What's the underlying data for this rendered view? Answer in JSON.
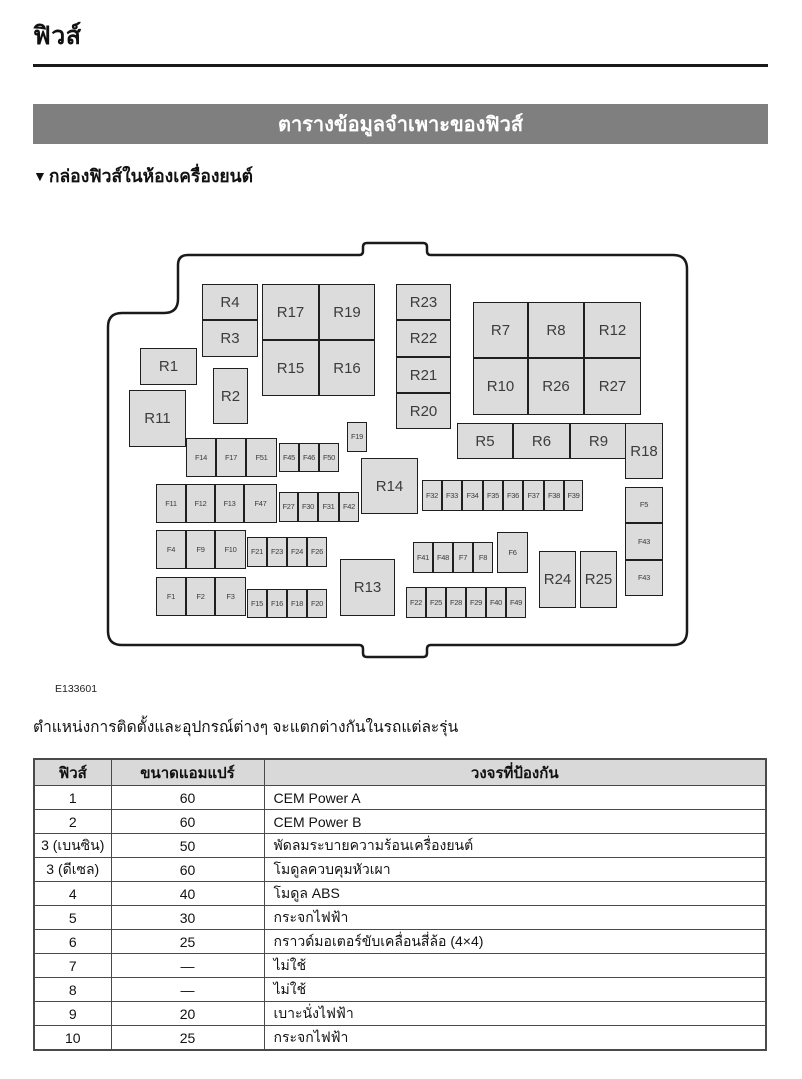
{
  "header": {
    "title": "ฟิวส์",
    "banner": "ตารางข้อมูลจำเพาะของฟิวส์",
    "subsection_marker": "▼",
    "subsection": "กล่องฟิวส์ในห้องเครื่องยนต์"
  },
  "figure": {
    "caption": "E133601",
    "boxes": [
      {
        "id": "R4",
        "x": 99,
        "y": 44,
        "w": 56,
        "h": 36,
        "size": "lg"
      },
      {
        "id": "R3",
        "x": 99,
        "y": 80,
        "w": 56,
        "h": 37,
        "size": "lg"
      },
      {
        "id": "R17",
        "x": 159,
        "y": 44,
        "w": 57,
        "h": 56,
        "size": "lg"
      },
      {
        "id": "R19",
        "x": 216,
        "y": 44,
        "w": 56,
        "h": 56,
        "size": "lg"
      },
      {
        "id": "R15",
        "x": 159,
        "y": 100,
        "w": 57,
        "h": 56,
        "size": "lg"
      },
      {
        "id": "R16",
        "x": 216,
        "y": 100,
        "w": 56,
        "h": 56,
        "size": "lg"
      },
      {
        "id": "R1",
        "x": 37,
        "y": 108,
        "w": 57,
        "h": 37,
        "size": "lg"
      },
      {
        "id": "R2",
        "x": 110,
        "y": 128,
        "w": 35,
        "h": 56,
        "size": "lg"
      },
      {
        "id": "R11",
        "x": 26,
        "y": 150,
        "w": 57,
        "h": 57,
        "size": "lg"
      },
      {
        "id": "R23",
        "x": 293,
        "y": 44,
        "w": 55,
        "h": 36,
        "size": "lg"
      },
      {
        "id": "R22",
        "x": 293,
        "y": 80,
        "w": 55,
        "h": 37,
        "size": "lg"
      },
      {
        "id": "R21",
        "x": 293,
        "y": 117,
        "w": 55,
        "h": 36,
        "size": "lg"
      },
      {
        "id": "R20",
        "x": 293,
        "y": 153,
        "w": 55,
        "h": 36,
        "size": "lg"
      },
      {
        "id": "R7",
        "x": 370,
        "y": 62,
        "w": 55,
        "h": 56,
        "size": "lg"
      },
      {
        "id": "R8",
        "x": 425,
        "y": 62,
        "w": 56,
        "h": 56,
        "size": "lg"
      },
      {
        "id": "R12",
        "x": 481,
        "y": 62,
        "w": 57,
        "h": 56,
        "size": "lg"
      },
      {
        "id": "R10",
        "x": 370,
        "y": 118,
        "w": 55,
        "h": 57,
        "size": "lg"
      },
      {
        "id": "R26",
        "x": 425,
        "y": 118,
        "w": 56,
        "h": 57,
        "size": "lg"
      },
      {
        "id": "R27",
        "x": 481,
        "y": 118,
        "w": 57,
        "h": 57,
        "size": "lg"
      },
      {
        "id": "R5",
        "x": 354,
        "y": 183,
        "w": 56,
        "h": 36,
        "size": "lg"
      },
      {
        "id": "R6",
        "x": 410,
        "y": 183,
        "w": 57,
        "h": 36,
        "size": "lg"
      },
      {
        "id": "R9",
        "x": 467,
        "y": 183,
        "w": 57,
        "h": 36,
        "size": "lg"
      },
      {
        "id": "R18",
        "x": 522,
        "y": 183,
        "w": 38,
        "h": 56,
        "size": "lg"
      },
      {
        "id": "R14",
        "x": 258,
        "y": 218,
        "w": 57,
        "h": 56,
        "size": "lg"
      },
      {
        "id": "R13",
        "x": 237,
        "y": 319,
        "w": 55,
        "h": 57,
        "size": "lg"
      },
      {
        "id": "R24",
        "x": 436,
        "y": 311,
        "w": 37,
        "h": 57,
        "size": "lg"
      },
      {
        "id": "R25",
        "x": 477,
        "y": 311,
        "w": 37,
        "h": 57,
        "size": "lg"
      },
      {
        "id": "F14",
        "x": 83,
        "y": 198,
        "w": 30,
        "h": 39,
        "size": "sm"
      },
      {
        "id": "F17",
        "x": 113,
        "y": 198,
        "w": 30,
        "h": 39,
        "size": "sm"
      },
      {
        "id": "F51",
        "x": 143,
        "y": 198,
        "w": 31,
        "h": 39,
        "size": "sm"
      },
      {
        "id": "F45",
        "x": 176,
        "y": 203,
        "w": 20,
        "h": 29,
        "size": "sm"
      },
      {
        "id": "F46",
        "x": 196,
        "y": 203,
        "w": 20,
        "h": 29,
        "size": "sm"
      },
      {
        "id": "F50",
        "x": 216,
        "y": 203,
        "w": 20,
        "h": 29,
        "size": "sm"
      },
      {
        "id": "F11",
        "x": 53,
        "y": 244,
        "w": 30,
        "h": 39,
        "size": "sm"
      },
      {
        "id": "F12",
        "x": 83,
        "y": 244,
        "w": 29,
        "h": 39,
        "size": "sm"
      },
      {
        "id": "F13",
        "x": 112,
        "y": 244,
        "w": 29,
        "h": 39,
        "size": "sm"
      },
      {
        "id": "F47",
        "x": 141,
        "y": 244,
        "w": 33,
        "h": 39,
        "size": "sm"
      },
      {
        "id": "F27",
        "x": 176,
        "y": 252,
        "w": 19,
        "h": 30,
        "size": "sm"
      },
      {
        "id": "F30",
        "x": 195,
        "y": 252,
        "w": 20,
        "h": 30,
        "size": "sm"
      },
      {
        "id": "F31",
        "x": 215,
        "y": 252,
        "w": 21,
        "h": 30,
        "size": "sm"
      },
      {
        "id": "F42",
        "x": 236,
        "y": 252,
        "w": 20,
        "h": 30,
        "size": "sm"
      },
      {
        "id": "F4",
        "x": 53,
        "y": 290,
        "w": 30,
        "h": 39,
        "size": "sm"
      },
      {
        "id": "F9",
        "x": 83,
        "y": 290,
        "w": 29,
        "h": 39,
        "size": "sm"
      },
      {
        "id": "F10",
        "x": 112,
        "y": 290,
        "w": 31,
        "h": 39,
        "size": "sm"
      },
      {
        "id": "F21",
        "x": 144,
        "y": 297,
        "w": 20,
        "h": 30,
        "size": "sm"
      },
      {
        "id": "F23",
        "x": 164,
        "y": 297,
        "w": 20,
        "h": 30,
        "size": "sm"
      },
      {
        "id": "F24",
        "x": 184,
        "y": 297,
        "w": 20,
        "h": 30,
        "size": "sm"
      },
      {
        "id": "F26",
        "x": 204,
        "y": 297,
        "w": 20,
        "h": 30,
        "size": "sm"
      },
      {
        "id": "F1",
        "x": 53,
        "y": 337,
        "w": 30,
        "h": 39,
        "size": "sm"
      },
      {
        "id": "F2",
        "x": 83,
        "y": 337,
        "w": 29,
        "h": 39,
        "size": "sm"
      },
      {
        "id": "F3",
        "x": 112,
        "y": 337,
        "w": 31,
        "h": 39,
        "size": "sm"
      },
      {
        "id": "F15",
        "x": 144,
        "y": 349,
        "w": 20,
        "h": 29,
        "size": "sm"
      },
      {
        "id": "F16",
        "x": 164,
        "y": 349,
        "w": 20,
        "h": 29,
        "size": "sm"
      },
      {
        "id": "F18",
        "x": 184,
        "y": 349,
        "w": 20,
        "h": 29,
        "size": "sm"
      },
      {
        "id": "F20",
        "x": 204,
        "y": 349,
        "w": 20,
        "h": 29,
        "size": "sm"
      },
      {
        "id": "F19",
        "x": 244,
        "y": 182,
        "w": 20,
        "h": 30,
        "size": "sm"
      },
      {
        "id": "F32",
        "x": 319,
        "y": 240,
        "w": 20,
        "h": 31,
        "size": "sm"
      },
      {
        "id": "F33",
        "x": 339,
        "y": 240,
        "w": 20,
        "h": 31,
        "size": "sm"
      },
      {
        "id": "F34",
        "x": 359,
        "y": 240,
        "w": 21,
        "h": 31,
        "size": "sm"
      },
      {
        "id": "F35",
        "x": 380,
        "y": 240,
        "w": 20,
        "h": 31,
        "size": "sm"
      },
      {
        "id": "F36",
        "x": 400,
        "y": 240,
        "w": 20,
        "h": 31,
        "size": "sm"
      },
      {
        "id": "F37",
        "x": 420,
        "y": 240,
        "w": 21,
        "h": 31,
        "size": "sm"
      },
      {
        "id": "F38",
        "x": 441,
        "y": 240,
        "w": 20,
        "h": 31,
        "size": "sm"
      },
      {
        "id": "F39",
        "x": 461,
        "y": 240,
        "w": 19,
        "h": 31,
        "size": "sm"
      },
      {
        "id": "F41",
        "x": 310,
        "y": 302,
        "w": 20,
        "h": 31,
        "size": "sm"
      },
      {
        "id": "F48",
        "x": 330,
        "y": 302,
        "w": 20,
        "h": 31,
        "size": "sm"
      },
      {
        "id": "F7",
        "x": 350,
        "y": 302,
        "w": 20,
        "h": 31,
        "size": "sm"
      },
      {
        "id": "F8",
        "x": 370,
        "y": 302,
        "w": 20,
        "h": 31,
        "size": "sm"
      },
      {
        "id": "F6",
        "x": 394,
        "y": 292,
        "w": 31,
        "h": 41,
        "size": "sm"
      },
      {
        "id": "F22",
        "x": 303,
        "y": 347,
        "w": 20,
        "h": 31,
        "size": "sm"
      },
      {
        "id": "F25",
        "x": 323,
        "y": 347,
        "w": 20,
        "h": 31,
        "size": "sm"
      },
      {
        "id": "F28",
        "x": 343,
        "y": 347,
        "w": 20,
        "h": 31,
        "size": "sm"
      },
      {
        "id": "F29",
        "x": 363,
        "y": 347,
        "w": 20,
        "h": 31,
        "size": "sm"
      },
      {
        "id": "F40",
        "x": 383,
        "y": 347,
        "w": 20,
        "h": 31,
        "size": "sm"
      },
      {
        "id": "F49",
        "x": 403,
        "y": 347,
        "w": 20,
        "h": 31,
        "size": "sm"
      },
      {
        "id": "F5",
        "x": 522,
        "y": 247,
        "w": 38,
        "h": 36,
        "size": "sm"
      },
      {
        "id": "F43",
        "x": 522,
        "y": 283,
        "w": 38,
        "h": 37,
        "size": "sm"
      },
      {
        "id": "F43",
        "x": 522,
        "y": 320,
        "w": 38,
        "h": 36,
        "size": "sm"
      }
    ]
  },
  "note": "ตำแหน่งการติดตั้งและอุปกรณ์ต่างๆ จะแตกต่างกันในรถแต่ละรุ่น",
  "table": {
    "headers": [
      "ฟิวส์",
      "ขนาดแอมแปร์",
      "วงจรที่ป้องกัน"
    ],
    "rows": [
      [
        "1",
        "60",
        "CEM Power A"
      ],
      [
        "2",
        "60",
        "CEM Power B"
      ],
      [
        "3 (เบนซิน)",
        "50",
        "พัดลมระบายความร้อนเครื่องยนต์"
      ],
      [
        "3 (ดีเซล)",
        "60",
        "โมดูลควบคุมหัวเผา"
      ],
      [
        "4",
        "40",
        "โมดูล ABS"
      ],
      [
        "5",
        "30",
        "กระจกไฟฟ้า"
      ],
      [
        "6",
        "25",
        "กราวด์มอเตอร์ขับเคลื่อนสี่ล้อ (4×4)"
      ],
      [
        "7",
        "—",
        "ไม่ใช้"
      ],
      [
        "8",
        "—",
        "ไม่ใช้"
      ],
      [
        "9",
        "20",
        "เบาะนั่งไฟฟ้า"
      ],
      [
        "10",
        "25",
        "กระจกไฟฟ้า"
      ]
    ]
  },
  "colors": {
    "banner_bg": "#7f7f7f",
    "box_fill": "#dcdcdc",
    "box_border": "#1f1f1f",
    "table_header_bg": "#d9d9d9",
    "table_border": "#4a4a4a",
    "outline_stroke": "#1a1a1a"
  }
}
